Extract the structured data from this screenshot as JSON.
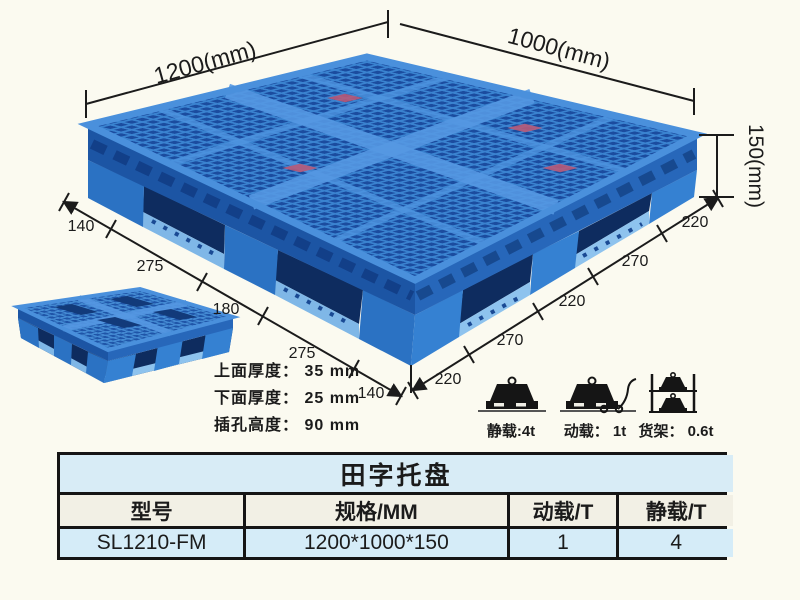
{
  "product": {
    "dimensions": {
      "length_label": "1200(mm)",
      "width_label": "1000(mm)",
      "height_label": "150(mm)",
      "left_edge_segments": [
        "140",
        "275",
        "180",
        "275",
        "140"
      ],
      "right_edge_segments": [
        "220",
        "270",
        "220",
        "270",
        "220"
      ]
    },
    "specs": [
      {
        "text": "上面厚度： 35 mm"
      },
      {
        "text": "下面厚度： 25 mm"
      },
      {
        "text": "插孔高度： 90 mm"
      }
    ],
    "load_ratings": [
      {
        "name": "static-load",
        "label": "静载:4t"
      },
      {
        "name": "dynamic-load",
        "label": "动载： 1t"
      },
      {
        "name": "rack-load",
        "label": "货架： 0.6t"
      }
    ]
  },
  "table": {
    "title": "田字托盘",
    "headers": [
      "型号",
      "规格/MM",
      "动载/T",
      "静载/T"
    ],
    "row": [
      "SL1210-FM",
      "1200*1000*150",
      "1",
      "4"
    ]
  },
  "colors": {
    "background": "#fbfaf0",
    "pallet_blue": "#2e7bcb",
    "pallet_hole_blue": "#1b4c9f",
    "table_title_bg": "#d8ecf6",
    "table_header_bg": "#f2f0e5",
    "table_row_bg": "#d5ecf8",
    "line_black": "#1b1b1b"
  }
}
